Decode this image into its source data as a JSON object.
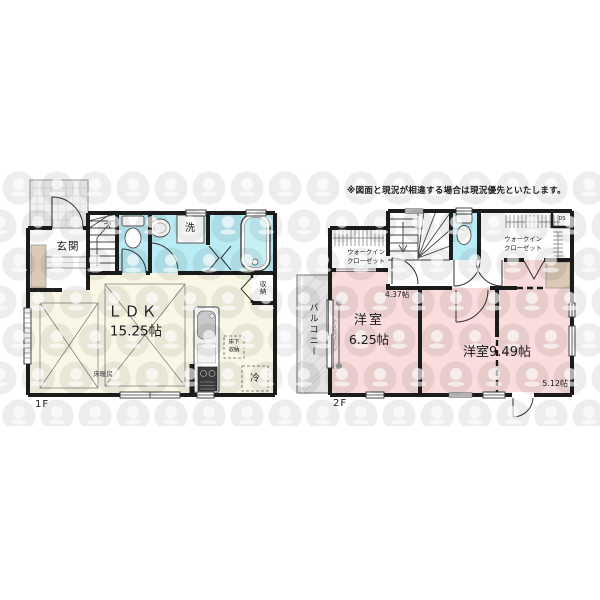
{
  "disclaimer": "※図面と現況が相違する場合は現況優先といたします。",
  "floor1": {
    "floor_label": "1F",
    "entrance": "玄関",
    "laundry": "洗",
    "ldk_name": "ＬＤＫ",
    "ldk_size": "15.25帖",
    "floor_heating": "床暖房",
    "storage": "収納",
    "underfloor_storage_line1": "床下",
    "underfloor_storage_line2": "収納",
    "refrigerator": "冷"
  },
  "floor2": {
    "floor_label": "2F",
    "balcony": "バルコニー",
    "laundry_pole": "ホスクリーン",
    "bedroom1_name": "洋室",
    "bedroom1_size": "6.25帖",
    "bedroom2": "洋室9.49帖",
    "bedroom2_sub_size1": "4.37帖",
    "bedroom2_sub_size2": "5.12帖",
    "wic_left_line1": "ウォークイン",
    "wic_left_line2": "クローゼット",
    "wic_right_line1": "ウォークイン",
    "wic_right_line2": "クローゼット",
    "duct_space": "DS"
  },
  "colors": {
    "room_cream": "#faf7e6",
    "room_pink": "#fadcdc",
    "wet_cyan": "#b9ecf4",
    "balcony_gray": "#e4e4e4",
    "cabinet_tan": "#d9c9b5",
    "wall": "#1c1c1c"
  }
}
